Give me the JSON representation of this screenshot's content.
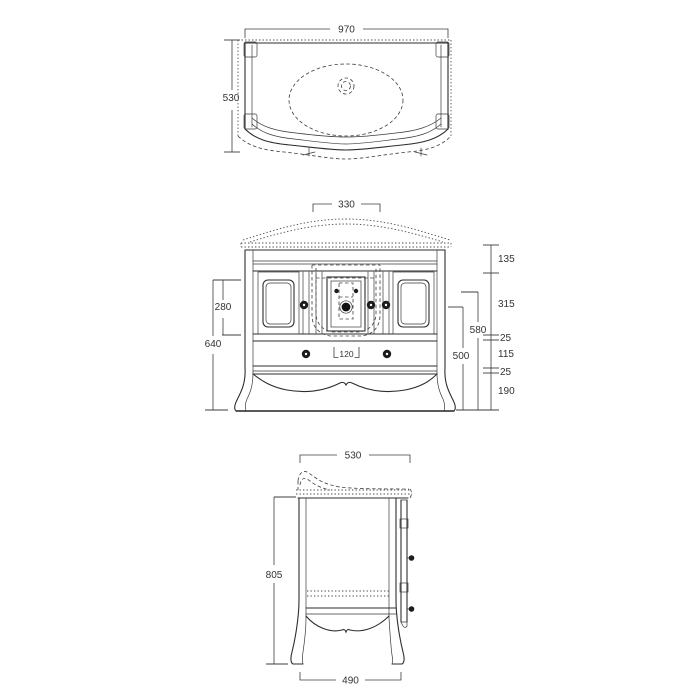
{
  "drawing": {
    "type": "furniture-technical-drawing",
    "subject": "bathroom vanity cabinet with basin, three orthographic views"
  },
  "dims": {
    "top_width": "970",
    "top_depth": "530",
    "front_basin_width": "330",
    "front_counter_height": "135",
    "front_door_opening": "315",
    "front_rail_upper": "25",
    "front_drawer_height": "115",
    "front_rail_lower": "25",
    "front_leg_height": "190",
    "front_drain_height": "580",
    "front_knob_height": "500",
    "front_door_height": "280",
    "front_body_height": "640",
    "front_siphon_width": "120",
    "side_depth": "530",
    "side_height": "805",
    "side_base_depth": "490"
  }
}
